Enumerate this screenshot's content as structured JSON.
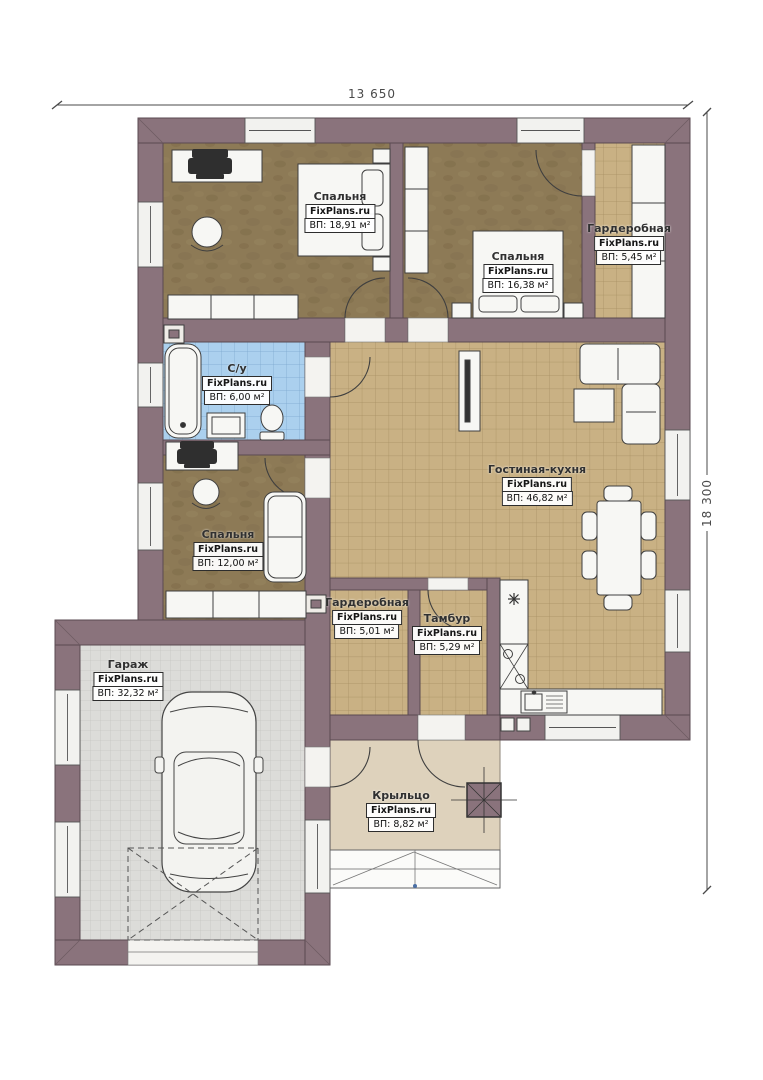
{
  "plan": {
    "brand": "FixPlans.ru",
    "dimensions": {
      "width_label": "13 650",
      "height_label": "18 300"
    },
    "rooms": [
      {
        "id": "bedroom-1",
        "name": "Спальня",
        "area": "ВП: 18,91 м²"
      },
      {
        "id": "bedroom-2",
        "name": "Спальня",
        "area": "ВП: 16,38 м²"
      },
      {
        "id": "wardrobe-top",
        "name": "Гардеробная",
        "area": "ВП: 5,45 м²"
      },
      {
        "id": "bathroom",
        "name": "С/у",
        "area": "ВП: 6,00 м²"
      },
      {
        "id": "bedroom-3",
        "name": "Спальня",
        "area": "ВП: 12,00 м²"
      },
      {
        "id": "living-kitchen",
        "name": "Гостиная-кухня",
        "area": "ВП: 46,82 м²"
      },
      {
        "id": "wardrobe-bottom",
        "name": "Гардеробная",
        "area": "ВП: 5,01 м²"
      },
      {
        "id": "vestibule",
        "name": "Тамбур",
        "area": "ВП: 5,29 м²"
      },
      {
        "id": "garage",
        "name": "Гараж",
        "area": "ВП: 32,32 м²"
      },
      {
        "id": "porch",
        "name": "Крыльцо",
        "area": "ВП: 8,82 м²"
      }
    ],
    "colors": {
      "wall": "#8a737c",
      "wall-line": "#5a4a51",
      "bedroom-floor": "#8d7a56",
      "tile-beige": "#c9b184",
      "tile-beige-line": "#a68e61",
      "tile-blue": "#abd0ee",
      "tile-blue-line": "#7ba6cd",
      "garage-floor": "#dcdcd9",
      "garage-floor-line": "#bfbfba",
      "porch-floor": "#ded2bc",
      "furniture": "#f7f7f4",
      "outline": "#3f3f3f",
      "dimension": "#4a4a4a",
      "label-text": "#303030"
    }
  }
}
